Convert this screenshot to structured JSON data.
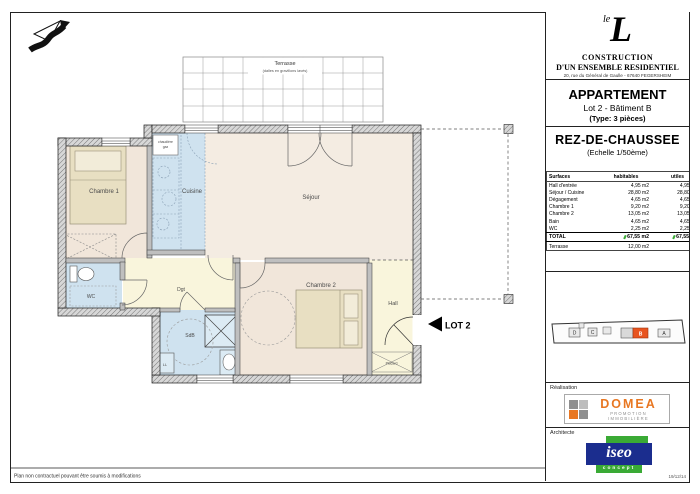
{
  "colors": {
    "accent_orange": "#e87722",
    "highlight_building": "#e8541f",
    "brand_navy": "#1b2d8e",
    "brand_green": "#3aaa35",
    "room_blue": "#cfe2ef",
    "room_beige": "#f1e6da",
    "room_cream": "#f4ece2",
    "room_yellow": "#f9f5dc"
  },
  "plan": {
    "terrasse": {
      "label": "Terrasse",
      "sublabel": "(dalles en gravillons lavés)"
    },
    "labels": {
      "chambre1": "Chambre 1",
      "cuisine": "Cuisine",
      "sejour": "Séjour",
      "chambre2": "Chambre 2",
      "hall": "Hall",
      "dgt": "Dgt",
      "wc": "WC",
      "sdb": "SdB",
      "ll": "LL",
      "placard": "Placard",
      "chaudiere_line1": "chaudière",
      "chaudiere_line2": "gaz"
    },
    "lot_marker": "LOT 2",
    "footnote": "Plan non contractuel pouvant être soumis à modifications"
  },
  "titleblock": {
    "logo": {
      "le": "le",
      "l": "L",
      "line1": "CONSTRUCTION",
      "line2": "D'UN ENSEMBLE RESIDENTIEL",
      "address": "20, rue du Général de Gaulle - 67640 FEGERSHEIM"
    },
    "apartment": {
      "title": "APPARTEMENT",
      "subtitle": "Lot 2 - Bâtiment B",
      "type": "(Type: 3 pièces)"
    },
    "level": {
      "title": "REZ-DE-CHAUSSEE",
      "scale": "(Echelle 1/50ème)"
    },
    "surface_table": {
      "headers": {
        "col1": "Surfaces",
        "col2": "habitables",
        "col3": "utiles"
      },
      "rows": [
        {
          "label": "Hall d'entrée",
          "habitables": "4,95 m2",
          "utiles": "4,95 m2"
        },
        {
          "label": "Séjour / Cuisine",
          "habitables": "28,80 m2",
          "utiles": "28,80 m2"
        },
        {
          "label": "Dégagement",
          "habitables": "4,65 m2",
          "utiles": "4,65 m2"
        },
        {
          "label": "Chambre 1",
          "habitables": "9,20 m2",
          "utiles": "9,20 m2"
        },
        {
          "label": "Chambre 2",
          "habitables": "13,05 m2",
          "utiles": "13,05 m2"
        },
        {
          "label": "Bain",
          "habitables": "4,65 m2",
          "utiles": "4,65 m2"
        },
        {
          "label": "WC",
          "habitables": "2,25 m2",
          "utiles": "2,25 m2"
        }
      ],
      "total": {
        "label": "TOTAL",
        "habitables": "67,55 m2",
        "utiles": "67,55 m2"
      },
      "terrasse": {
        "label": "Terrasse",
        "habitables": "12,00 m2"
      }
    },
    "siteplan": {
      "labels": {
        "d": "D",
        "c": "C",
        "b": "B",
        "a": "A"
      }
    },
    "realisation": {
      "section_label": "Réalisation",
      "brand": "DOMEA",
      "tagline": "PROMOTION IMMOBILIÈRE"
    },
    "architecte": {
      "section_label": "Architecte",
      "brand": "iseo",
      "tagline": "concept"
    },
    "date": "19/12/14"
  }
}
